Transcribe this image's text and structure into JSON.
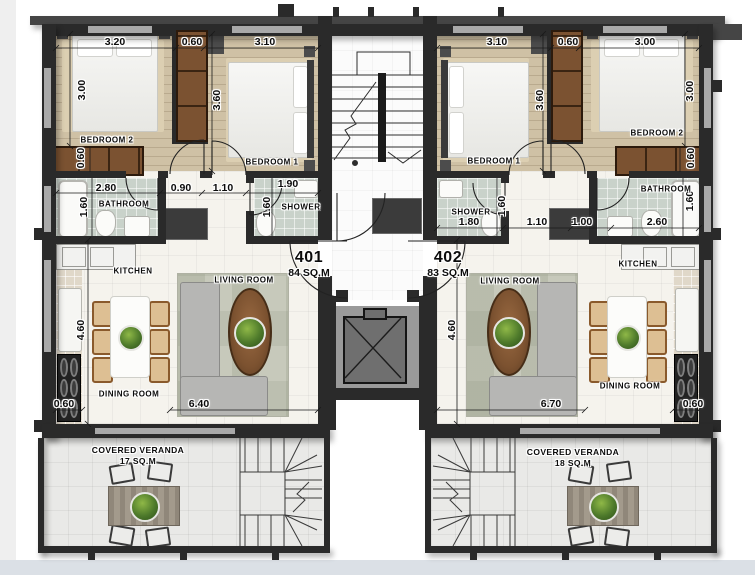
{
  "palette": {
    "wall": "#2a2a2a",
    "wall_light": "#454545",
    "wood_floor": "#cfc1a5",
    "bath_tile": "#c9d2ca",
    "living_floor": "#f5f3ed",
    "veranda_floor": "#e9e9e7",
    "wardrobe_wood": "#7b5231",
    "page_bottom_band": "#dbe0e6"
  },
  "units": [
    {
      "number": "401",
      "area": "84 SQ.M",
      "rooms": {
        "bedroom1": "BEDROOM 1",
        "bedroom2": "BEDROOM 2",
        "bathroom": "BATHROOM",
        "shower": "SHOWER",
        "kitchen": "KITCHEN",
        "living": "LIVING ROOM",
        "dining": "DINING ROOM",
        "veranda": "COVERED VERANDA",
        "veranda_area": "17 SQ.M"
      },
      "dims": {
        "top_a": "3.20",
        "top_b": "0.60",
        "top_c": "3.10",
        "bed2_depth": "3.00",
        "bed1_depth": "3.60",
        "wardrobe": "0.60",
        "bath_w": "2.80",
        "bath_d": "1.60",
        "hall_a": "0.90",
        "hall_b": "1.10",
        "shower_w": "1.90",
        "shower_d": "1.60",
        "living_h": "4.60",
        "living_w": "6.40",
        "counter": "0.60"
      }
    },
    {
      "number": "402",
      "area": "83 SQ.M",
      "rooms": {
        "bedroom1": "BEDROOM 1",
        "bedroom2": "BEDROOM 2",
        "bathroom": "BATHROOM",
        "shower": "SHOWER",
        "kitchen": "KITCHEN",
        "living": "LIVING ROOM",
        "dining": "DINING ROOM",
        "veranda": "COVERED VERANDA",
        "veranda_area": "18 SQ.M"
      },
      "dims": {
        "top_a": "3.10",
        "top_b": "0.60",
        "top_c": "3.00",
        "bed1_depth": "3.60",
        "bed2_depth": "3.00",
        "wardrobe": "0.60",
        "shower_w": "1.80",
        "shower_d": "1.60",
        "hall_a": "1.10",
        "closet": "1.00",
        "bath_w": "2.60",
        "bath_d": "1.60",
        "living_h": "4.60",
        "living_w": "6.70",
        "counter": "0.60"
      }
    }
  ]
}
